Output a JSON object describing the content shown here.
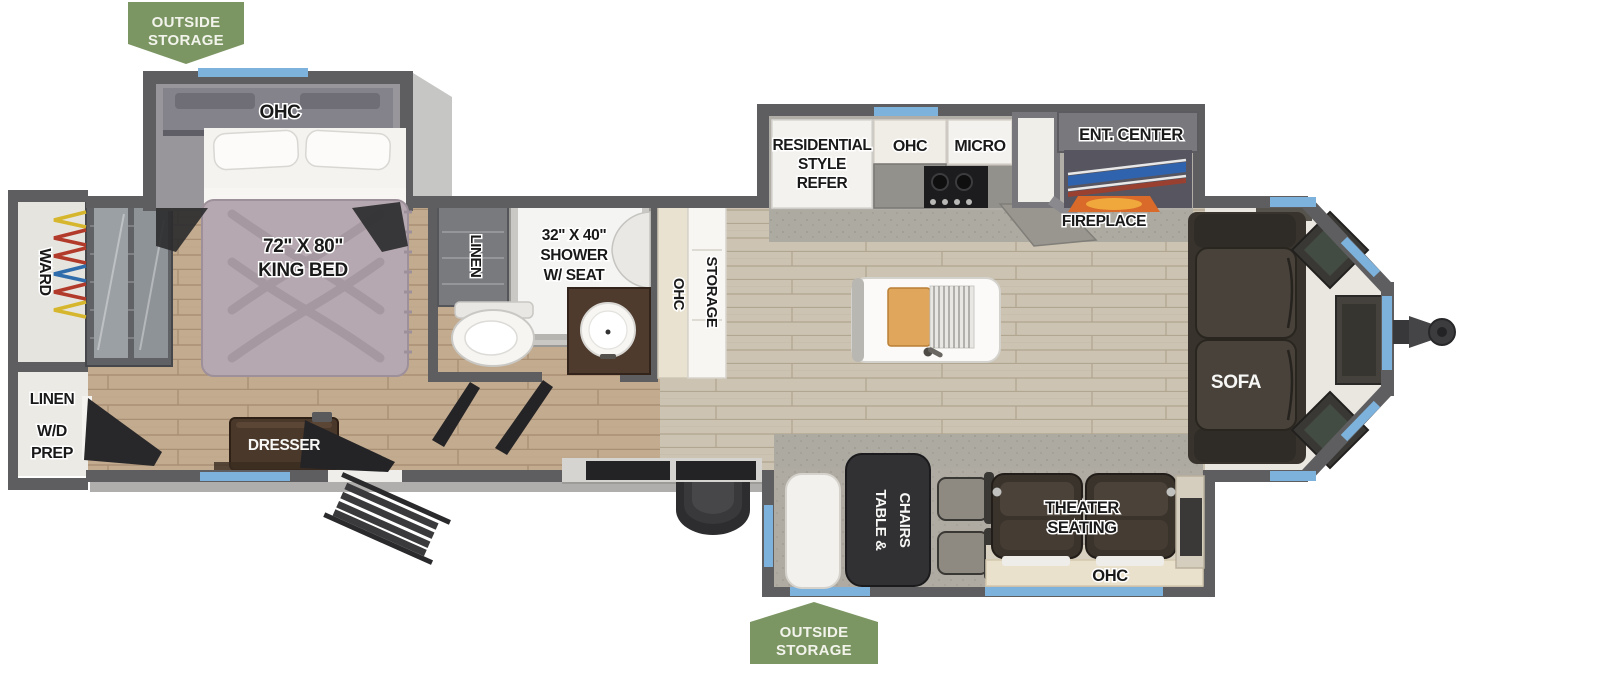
{
  "title": "Travel trailer floor plan",
  "colors": {
    "tag_green": "#7c9663",
    "wall_gray": "#5e5e60",
    "window_blue": "#7db2dc",
    "floor_wood_bedroom": "#c3ab90",
    "floor_wood_living": "#ccc3b2",
    "carpet_gray": "#adaaa2",
    "sofa_brown": "#45403a",
    "bed_blanket_mauve": "#b6a8b0",
    "fireplace_orange": "#d96a2a",
    "hanger_red": "#b23a2a",
    "hanger_blue": "#2e6cac",
    "hanger_yellow": "#d6b62c"
  },
  "labels": {
    "outside_storage_top": {
      "line1": "OUTSIDE",
      "line2": "STORAGE"
    },
    "outside_storage_bottom": {
      "line1": "OUTSIDE",
      "line2": "STORAGE"
    },
    "bedroom": {
      "ohc": "OHC",
      "bed_line1": "72\" X 80\"",
      "bed_line2": "KING BED",
      "dresser": "DRESSER"
    },
    "rear": {
      "ward": "WARD",
      "linen": "LINEN",
      "wd_line1": "W/D",
      "wd_line2": "PREP"
    },
    "bathroom": {
      "linen": "LINEN",
      "shower_line1": "32\" X 40\"",
      "shower_line2": "SHOWER",
      "shower_line3": "W/ SEAT"
    },
    "hall_cabinet": {
      "ohc": "OHC",
      "storage": "STORAGE"
    },
    "kitchen": {
      "refer_line1": "RESIDENTIAL",
      "refer_line2": "STYLE",
      "refer_line3": "REFER",
      "ohc": "OHC",
      "micro": "MICRO",
      "ent_center": "ENT. CENTER",
      "fireplace": "FIREPLACE"
    },
    "living": {
      "sofa": "SOFA",
      "table_line1": "TABLE &",
      "table_line2": "CHAIRS",
      "theater_line1": "THEATER",
      "theater_line2": "SEATING",
      "ohc": "OHC"
    }
  }
}
